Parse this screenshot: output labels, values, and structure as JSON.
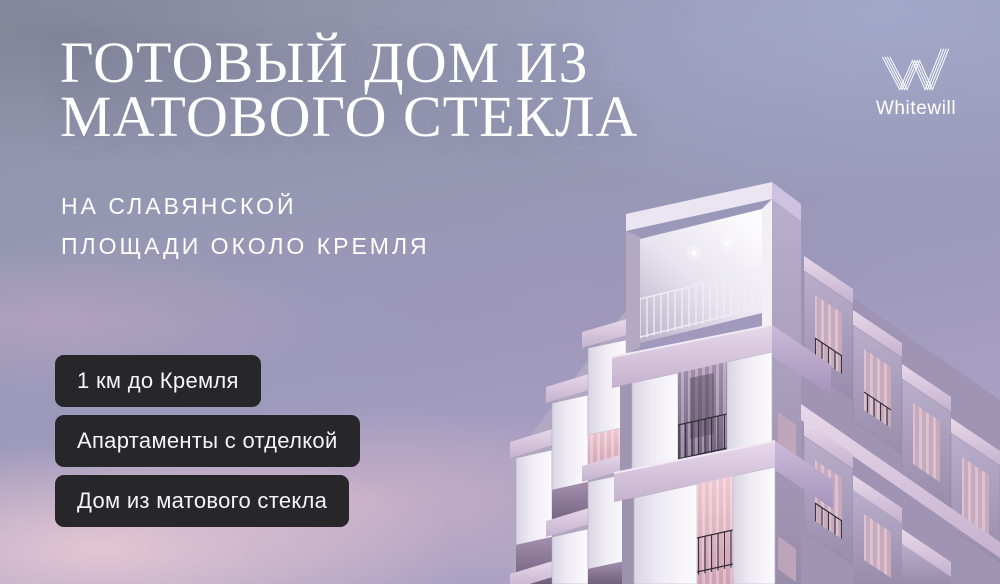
{
  "headline": {
    "line1": "ГОТОВЫЙ ДОМ ИЗ",
    "line2": "МАТОВОГО СТЕКЛА"
  },
  "subheadline": {
    "line1": "НА СЛАВЯНСКОЙ",
    "line2": "ПЛОЩАДИ ОКОЛО КРЕМЛЯ"
  },
  "badges": [
    {
      "label": "1 км до Кремля"
    },
    {
      "label": "Апартаменты с отделкой"
    },
    {
      "label": "Дом из матового стекла"
    }
  ],
  "logo": {
    "brand": "Whitewill",
    "mark": "striped-w-icon"
  },
  "scene": {
    "description": "3D render of a stepped cubic apartment building of frosted white glass, corner view, against a purple-pink dusk sky with clouds"
  },
  "colors": {
    "text": "#ffffff",
    "badge_bg": "#272629",
    "sky_top": "#8e91a6",
    "sky_purple": "#9d99bc",
    "cloud_pink": "#eccdd5",
    "building_white": "#f4f2f7",
    "building_shade": "#a99ec2",
    "slab_pink": "#dcc8e0"
  }
}
